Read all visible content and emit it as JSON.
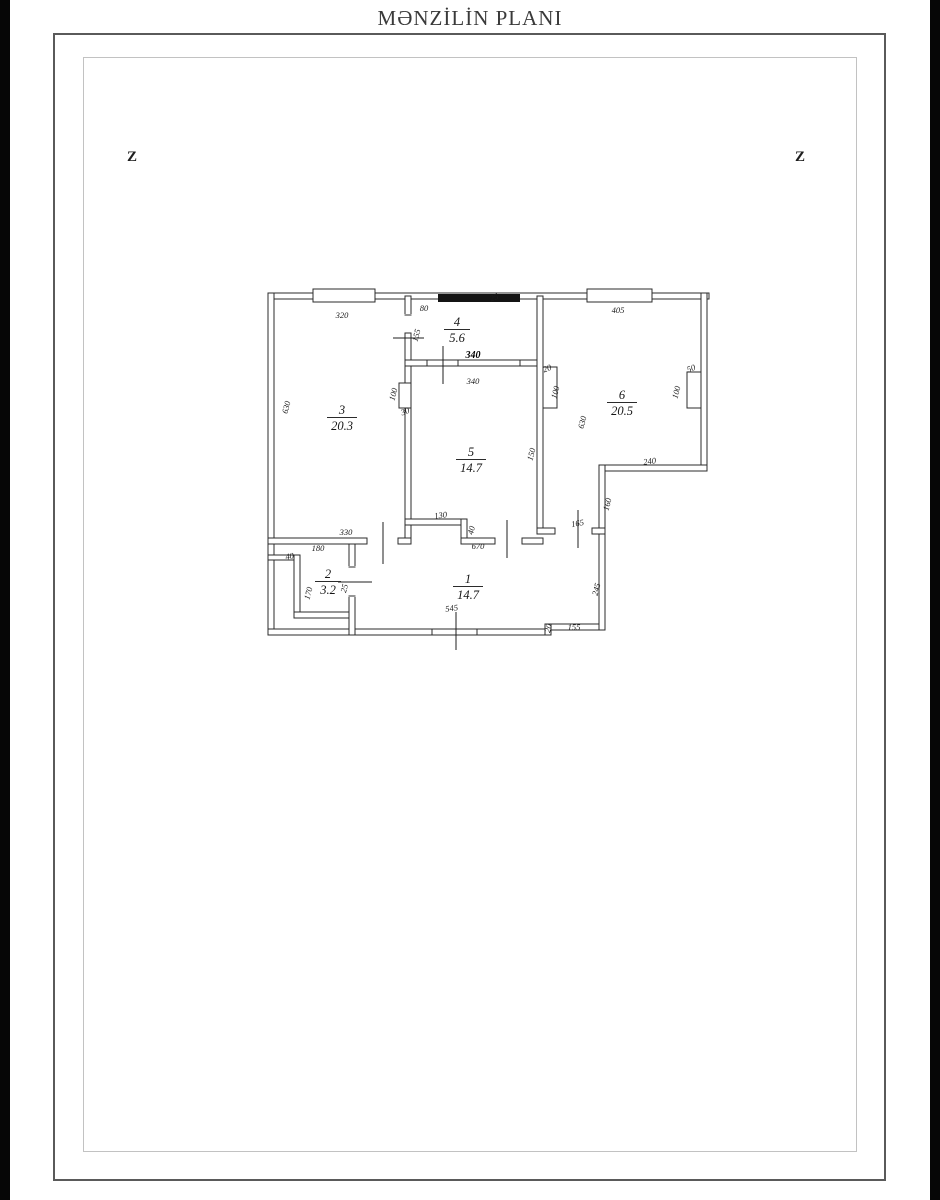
{
  "page": {
    "title": "MƏNZİLİN PLANI"
  },
  "orientation": {
    "left": "Z",
    "right": "Z"
  },
  "plan": {
    "rooms": [
      {
        "number": "1",
        "area": "14.7"
      },
      {
        "number": "2",
        "area": "3.2"
      },
      {
        "number": "3",
        "area": "20.3"
      },
      {
        "number": "4",
        "area": "5.6"
      },
      {
        "number": "5",
        "area": "14.7"
      },
      {
        "number": "6",
        "area": "20.5"
      }
    ],
    "bold_dim": "340",
    "dims": [
      {
        "t": "320",
        "x": 342,
        "y": 318,
        "r": 0
      },
      {
        "t": "80",
        "x": 424,
        "y": 311,
        "r": 0
      },
      {
        "t": "155",
        "x": 419,
        "y": 336,
        "r": -75
      },
      {
        "t": "25",
        "x": 495,
        "y": 300,
        "r": -20
      },
      {
        "t": "405",
        "x": 618,
        "y": 313,
        "r": 0
      },
      {
        "t": "340",
        "x": 473,
        "y": 384,
        "r": 0
      },
      {
        "t": "100",
        "x": 396,
        "y": 395,
        "r": -75
      },
      {
        "t": "30",
        "x": 406,
        "y": 414,
        "r": -20
      },
      {
        "t": "630",
        "x": 289,
        "y": 408,
        "r": -75
      },
      {
        "t": "20",
        "x": 548,
        "y": 371,
        "r": -20
      },
      {
        "t": "100",
        "x": 558,
        "y": 393,
        "r": -75
      },
      {
        "t": "630",
        "x": 585,
        "y": 423,
        "r": -75
      },
      {
        "t": "50",
        "x": 692,
        "y": 371,
        "r": -20
      },
      {
        "t": "100",
        "x": 679,
        "y": 393,
        "r": -75
      },
      {
        "t": "240",
        "x": 650,
        "y": 464,
        "r": -8
      },
      {
        "t": "160",
        "x": 610,
        "y": 505,
        "r": -75
      },
      {
        "t": "150",
        "x": 534,
        "y": 455,
        "r": -75
      },
      {
        "t": "130",
        "x": 441,
        "y": 518,
        "r": -8
      },
      {
        "t": "40",
        "x": 474,
        "y": 531,
        "r": -75
      },
      {
        "t": "330",
        "x": 346,
        "y": 535,
        "r": 0
      },
      {
        "t": "180",
        "x": 318,
        "y": 551,
        "r": 0
      },
      {
        "t": "40",
        "x": 290,
        "y": 559,
        "r": -10
      },
      {
        "t": "170",
        "x": 311,
        "y": 594,
        "r": -75
      },
      {
        "t": "25",
        "x": 347,
        "y": 589,
        "r": -75
      },
      {
        "t": "670",
        "x": 478,
        "y": 549,
        "r": 0
      },
      {
        "t": "165",
        "x": 578,
        "y": 526,
        "r": -10
      },
      {
        "t": "245",
        "x": 599,
        "y": 590,
        "r": -75
      },
      {
        "t": "545",
        "x": 452,
        "y": 611,
        "r": -8
      },
      {
        "t": "20",
        "x": 551,
        "y": 629,
        "r": -75
      },
      {
        "t": "155",
        "x": 574,
        "y": 630,
        "r": 0
      }
    ]
  }
}
